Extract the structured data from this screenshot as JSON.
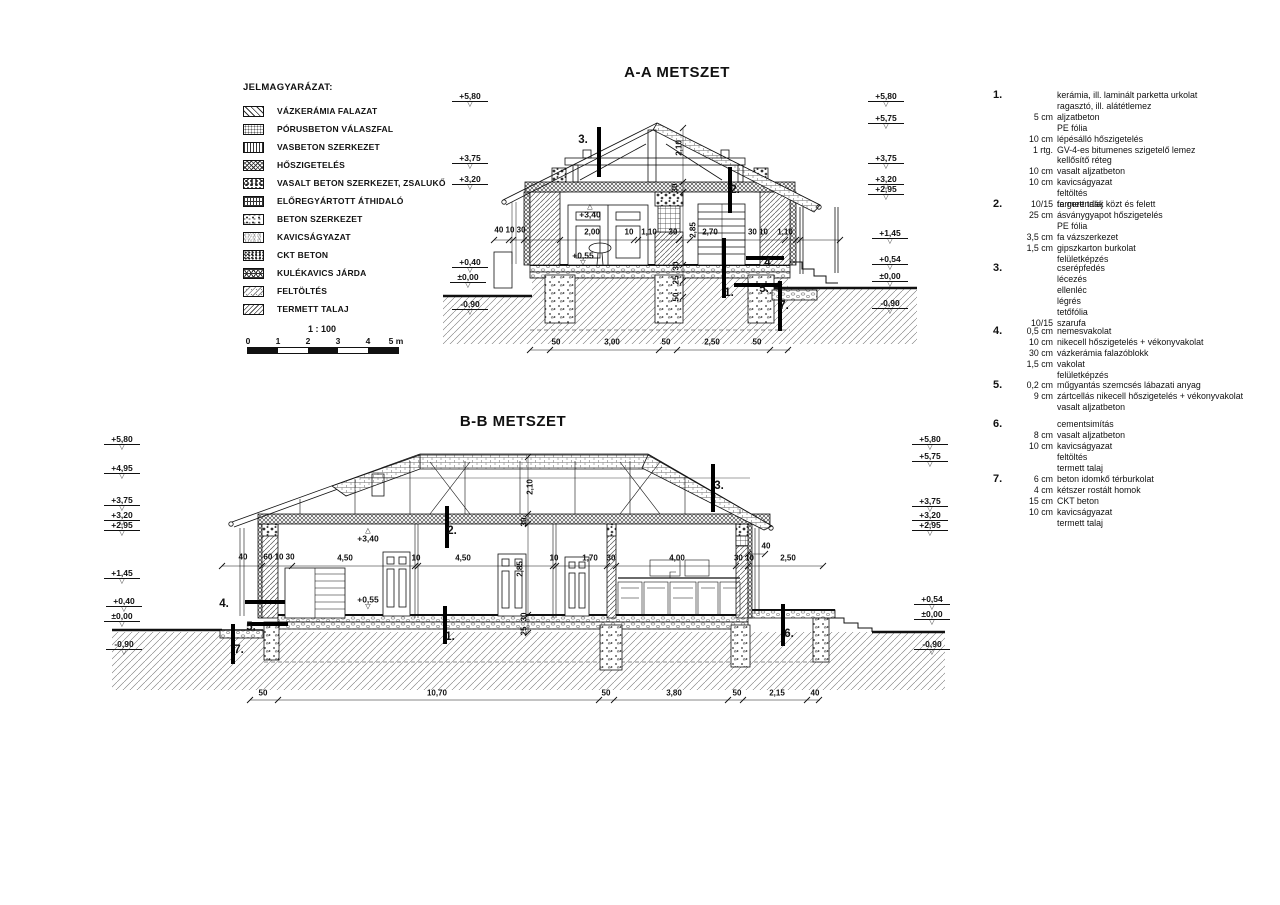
{
  "titles": {
    "aa": "A-A METSZET",
    "bb": "B-B METSZET"
  },
  "legend": {
    "title": "JELMAGYARÁZAT:",
    "items": [
      {
        "label": "VÁZKERÁMIA FALAZAT",
        "pattern": "diag"
      },
      {
        "label": "PÓRUSBETON VÁLASZFAL",
        "pattern": "dots"
      },
      {
        "label": "VASBETON SZERKEZET",
        "pattern": "vlines"
      },
      {
        "label": "HŐSZIGETELÉS",
        "pattern": "cross"
      },
      {
        "label": "VASALT BETON SZERKEZET, ZSALUKŐ",
        "pattern": "rubble"
      },
      {
        "label": "ELŐREGYÁRTOTT ÁTHIDALÓ",
        "pattern": "grid"
      },
      {
        "label": "BETON SZERKEZET",
        "pattern": "conc"
      },
      {
        "label": "KAVICSÁGYAZAT",
        "pattern": "gravel"
      },
      {
        "label": "CKT BETON",
        "pattern": "ckt"
      },
      {
        "label": "KULÉKAVICS JÁRDA",
        "pattern": "honey"
      },
      {
        "label": "FELTÖLTÉS",
        "pattern": "fill"
      },
      {
        "label": "TERMETT TALAJ",
        "pattern": "soil"
      }
    ]
  },
  "scalebar": {
    "ratio": "1 : 100",
    "labels": [
      {
        "t": "0",
        "x": 248,
        "y": 341
      },
      {
        "t": "1",
        "x": 278,
        "y": 341
      },
      {
        "t": "2",
        "x": 308,
        "y": 341
      },
      {
        "t": "3",
        "x": 338,
        "y": 341
      },
      {
        "t": "4",
        "x": 368,
        "y": 341
      },
      {
        "t": "5 m",
        "x": 396,
        "y": 341
      }
    ]
  },
  "aa": {
    "levels": [
      {
        "t": "+5,80",
        "x": 470,
        "y": 100
      },
      {
        "t": "+3,75",
        "x": 470,
        "y": 162
      },
      {
        "t": "+3,20",
        "x": 470,
        "y": 183
      },
      {
        "t": "+0,40",
        "x": 470,
        "y": 266
      },
      {
        "t": "±0,00",
        "x": 468,
        "y": 281
      },
      {
        "t": "-0,90",
        "x": 470,
        "y": 308
      },
      {
        "t": "+5,80",
        "x": 886,
        "y": 100
      },
      {
        "t": "+5,75",
        "x": 886,
        "y": 122
      },
      {
        "t": "+3,75",
        "x": 886,
        "y": 162
      },
      {
        "t": "+3,20",
        "x": 886,
        "y": 183
      },
      {
        "t": "+2,95",
        "x": 886,
        "y": 193
      },
      {
        "t": "+1,45",
        "x": 890,
        "y": 237
      },
      {
        "t": "+0,54",
        "x": 890,
        "y": 263
      },
      {
        "t": "±0,00",
        "x": 890,
        "y": 280
      },
      {
        "t": "-0,90",
        "x": 890,
        "y": 307
      }
    ],
    "spots": [
      {
        "t": "+3,40",
        "x": 590,
        "y": 212,
        "cls": "tri-up"
      },
      {
        "t": "+0,55",
        "x": 583,
        "y": 259,
        "cls": "tri-down"
      }
    ],
    "dims": [
      {
        "t": "40 10 30",
        "x": 510,
        "y": 230
      },
      {
        "t": "2,00",
        "x": 592,
        "y": 232
      },
      {
        "t": "10",
        "x": 629,
        "y": 232
      },
      {
        "t": "1,10",
        "x": 649,
        "y": 232
      },
      {
        "t": "30",
        "x": 673,
        "y": 232
      },
      {
        "t": "2,70",
        "x": 710,
        "y": 232
      },
      {
        "t": "30 10",
        "x": 758,
        "y": 232
      },
      {
        "t": "1,10",
        "x": 785,
        "y": 232
      },
      {
        "t": "2,10",
        "x": 679,
        "y": 148,
        "cls": "rot"
      },
      {
        "t": "30",
        "x": 675,
        "y": 188,
        "cls": "rot"
      },
      {
        "t": "2,85",
        "x": 693,
        "y": 230,
        "cls": "rot"
      },
      {
        "t": "30",
        "x": 676,
        "y": 266,
        "cls": "rot"
      },
      {
        "t": "25",
        "x": 676,
        "y": 280,
        "cls": "rot"
      },
      {
        "t": "50",
        "x": 676,
        "y": 297,
        "cls": "rot"
      },
      {
        "t": "50",
        "x": 556,
        "y": 342
      },
      {
        "t": "3,00",
        "x": 612,
        "y": 342
      },
      {
        "t": "50",
        "x": 666,
        "y": 342
      },
      {
        "t": "2,50",
        "x": 712,
        "y": 342
      },
      {
        "t": "50",
        "x": 757,
        "y": 342
      }
    ],
    "markers": [
      {
        "t": "3.",
        "x": 583,
        "y": 140,
        "bo": "v",
        "bx": 597,
        "by": 127,
        "bl": 50
      },
      {
        "t": "2.",
        "x": 735,
        "y": 190,
        "bo": "v",
        "bx": 728,
        "by": 167,
        "bl": 46
      },
      {
        "t": "4.",
        "x": 769,
        "y": 263,
        "bo": "h",
        "bx": 746,
        "by": 256,
        "bl": 38
      },
      {
        "t": "5.",
        "x": 764,
        "y": 289,
        "bo": "h",
        "bx": 734,
        "by": 283,
        "bl": 44
      },
      {
        "t": "7.",
        "x": 784,
        "y": 306,
        "bo": "v",
        "bx": 778,
        "by": 281,
        "bl": 50
      },
      {
        "t": "1.",
        "x": 729,
        "y": 293,
        "bo": "v",
        "bx": 722,
        "by": 238,
        "bl": 60
      }
    ]
  },
  "bb": {
    "levels": [
      {
        "t": "+5,80",
        "x": 122,
        "y": 443
      },
      {
        "t": "+4,95",
        "x": 122,
        "y": 472
      },
      {
        "t": "+3,75",
        "x": 122,
        "y": 504
      },
      {
        "t": "+3,20",
        "x": 122,
        "y": 519
      },
      {
        "t": "+2,95",
        "x": 122,
        "y": 529
      },
      {
        "t": "+1,45",
        "x": 122,
        "y": 577
      },
      {
        "t": "+0,40",
        "x": 124,
        "y": 605
      },
      {
        "t": "±0,00",
        "x": 122,
        "y": 620
      },
      {
        "t": "-0,90",
        "x": 124,
        "y": 648
      },
      {
        "t": "+5,80",
        "x": 930,
        "y": 443
      },
      {
        "t": "+5,75",
        "x": 930,
        "y": 460
      },
      {
        "t": "+3,75",
        "x": 930,
        "y": 505
      },
      {
        "t": "+3,20",
        "x": 930,
        "y": 519
      },
      {
        "t": "+2,95",
        "x": 930,
        "y": 529
      },
      {
        "t": "+0,54",
        "x": 932,
        "y": 603
      },
      {
        "t": "±0,00",
        "x": 932,
        "y": 618
      },
      {
        "t": "-0,90",
        "x": 932,
        "y": 648
      }
    ],
    "spots": [
      {
        "t": "+3,40",
        "x": 368,
        "y": 536,
        "cls": "tri-up"
      },
      {
        "t": "+0,55",
        "x": 368,
        "y": 603,
        "cls": "tri-down"
      }
    ],
    "dims": [
      {
        "t": "40",
        "x": 243,
        "y": 557
      },
      {
        "t": "60 10 30",
        "x": 279,
        "y": 557
      },
      {
        "t": "4,50",
        "x": 345,
        "y": 558
      },
      {
        "t": "10",
        "x": 416,
        "y": 558
      },
      {
        "t": "4,50",
        "x": 463,
        "y": 558
      },
      {
        "t": "10",
        "x": 554,
        "y": 558
      },
      {
        "t": "1,70",
        "x": 590,
        "y": 558
      },
      {
        "t": "30",
        "x": 611,
        "y": 558
      },
      {
        "t": "4,00",
        "x": 677,
        "y": 558
      },
      {
        "t": "30 10",
        "x": 744,
        "y": 558
      },
      {
        "t": "2,50",
        "x": 788,
        "y": 558
      },
      {
        "t": "40",
        "x": 766,
        "y": 546
      },
      {
        "t": "2,10",
        "x": 530,
        "y": 487,
        "cls": "rot"
      },
      {
        "t": "30",
        "x": 524,
        "y": 522,
        "cls": "rot"
      },
      {
        "t": "2,85",
        "x": 520,
        "y": 569,
        "cls": "rot"
      },
      {
        "t": "30",
        "x": 524,
        "y": 617,
        "cls": "rot"
      },
      {
        "t": "25",
        "x": 524,
        "y": 631,
        "cls": "rot"
      },
      {
        "t": "50",
        "x": 263,
        "y": 693
      },
      {
        "t": "10,70",
        "x": 437,
        "y": 693
      },
      {
        "t": "50",
        "x": 606,
        "y": 693
      },
      {
        "t": "3,80",
        "x": 674,
        "y": 693
      },
      {
        "t": "50",
        "x": 737,
        "y": 693
      },
      {
        "t": "2,15",
        "x": 777,
        "y": 693
      },
      {
        "t": "40",
        "x": 815,
        "y": 693
      }
    ],
    "markers": [
      {
        "t": "2.",
        "x": 452,
        "y": 531,
        "bo": "v",
        "bx": 445,
        "by": 506,
        "bl": 42
      },
      {
        "t": "3.",
        "x": 719,
        "y": 486,
        "bo": "v",
        "bx": 711,
        "by": 464,
        "bl": 48
      },
      {
        "t": "4.",
        "x": 224,
        "y": 604,
        "bo": "h",
        "bx": 245,
        "by": 600,
        "bl": 40
      },
      {
        "t": "5.",
        "x": 251,
        "y": 627,
        "bo": "h",
        "bx": 248,
        "by": 622,
        "bl": 40
      },
      {
        "t": "7.",
        "x": 239,
        "y": 650,
        "bo": "v",
        "bx": 231,
        "by": 624,
        "bl": 40
      },
      {
        "t": "1.",
        "x": 450,
        "y": 637,
        "bo": "v",
        "bx": 443,
        "by": 606,
        "bl": 38
      },
      {
        "t": "6.",
        "x": 789,
        "y": 634,
        "bo": "v",
        "bx": 781,
        "by": 604,
        "bl": 42
      }
    ]
  },
  "notes": [
    {
      "num": "1.",
      "y": 90,
      "rows": [
        {
          "s": "",
          "t": "kerámia, ill. laminált parketta urkolat"
        },
        {
          "s": "",
          "t": "ragasztó, ill. alátétlemez"
        },
        {
          "s": "5 cm",
          "t": "aljzatbeton"
        },
        {
          "s": "",
          "t": "PE fólia"
        },
        {
          "s": "10 cm",
          "t": "lépésálló hőszigetelés"
        },
        {
          "s": "1 rtg.",
          "t": "GV-4-es bitumenes szigetelő lemez"
        },
        {
          "s": "",
          "t": "kellősítő réteg"
        },
        {
          "s": "10 cm",
          "t": "vasalt aljzatbeton"
        },
        {
          "s": "10 cm",
          "t": "kavicságyazat"
        },
        {
          "s": "",
          "t": "feltöltés"
        },
        {
          "s": "",
          "t": "termett talaj"
        }
      ]
    },
    {
      "num": "2.",
      "y": 199,
      "rows": [
        {
          "s": "10/15",
          "t": "fa gerendák közt és felett"
        },
        {
          "s": "25 cm",
          "t": "ásványgyapot hőszigetelés"
        },
        {
          "s": "",
          "t": "PE fólia"
        },
        {
          "s": "3,5 cm",
          "t": "fa vázszerkezet"
        },
        {
          "s": "1,5 cm",
          "t": "gipszkarton burkolat"
        },
        {
          "s": "",
          "t": "felületképzés"
        }
      ]
    },
    {
      "num": "3.",
      "y": 263,
      "rows": [
        {
          "s": "",
          "t": "cserépfedés"
        },
        {
          "s": "",
          "t": "lécezés"
        },
        {
          "s": "",
          "t": "ellenléc"
        },
        {
          "s": "",
          "t": "légrés"
        },
        {
          "s": "",
          "t": "tetőfólia"
        },
        {
          "s": "10/15",
          "t": "szarufa"
        }
      ]
    },
    {
      "num": "4.",
      "y": 326,
      "rows": [
        {
          "s": "0,5 cm",
          "t": "nemesvakolat"
        },
        {
          "s": "10 cm",
          "t": "nikecell hőszigetelés + vékonyvakolat"
        },
        {
          "s": "30 cm",
          "t": "vázkerámia falazóblokk"
        },
        {
          "s": "1,5 cm",
          "t": "vakolat"
        },
        {
          "s": "",
          "t": "felületképzés"
        }
      ]
    },
    {
      "num": "5.",
      "y": 380,
      "rows": [
        {
          "s": "0,2 cm",
          "t": "műgyantás szemcsés lábazati anyag"
        },
        {
          "s": "9 cm",
          "t": "zártcellás nikecell hőszigetelés + vékonyvakolat"
        },
        {
          "s": "",
          "t": "vasalt aljzatbeton"
        }
      ]
    },
    {
      "num": "6.",
      "y": 419,
      "rows": [
        {
          "s": "",
          "t": "cementsimítás"
        },
        {
          "s": "8 cm",
          "t": "vasalt aljzatbeton"
        },
        {
          "s": "10 cm",
          "t": "kavicságyazat"
        },
        {
          "s": "",
          "t": "feltöltés"
        },
        {
          "s": "",
          "t": "termett talaj"
        }
      ]
    },
    {
      "num": "7.",
      "y": 474,
      "rows": [
        {
          "s": "6 cm",
          "t": "beton idomkő térburkolat"
        },
        {
          "s": "4 cm",
          "t": "kétszer rostált homok"
        },
        {
          "s": "15 cm",
          "t": "CKT beton"
        },
        {
          "s": "10 cm",
          "t": "kavicságyazat"
        },
        {
          "s": "",
          "t": "termett talaj"
        }
      ]
    }
  ]
}
